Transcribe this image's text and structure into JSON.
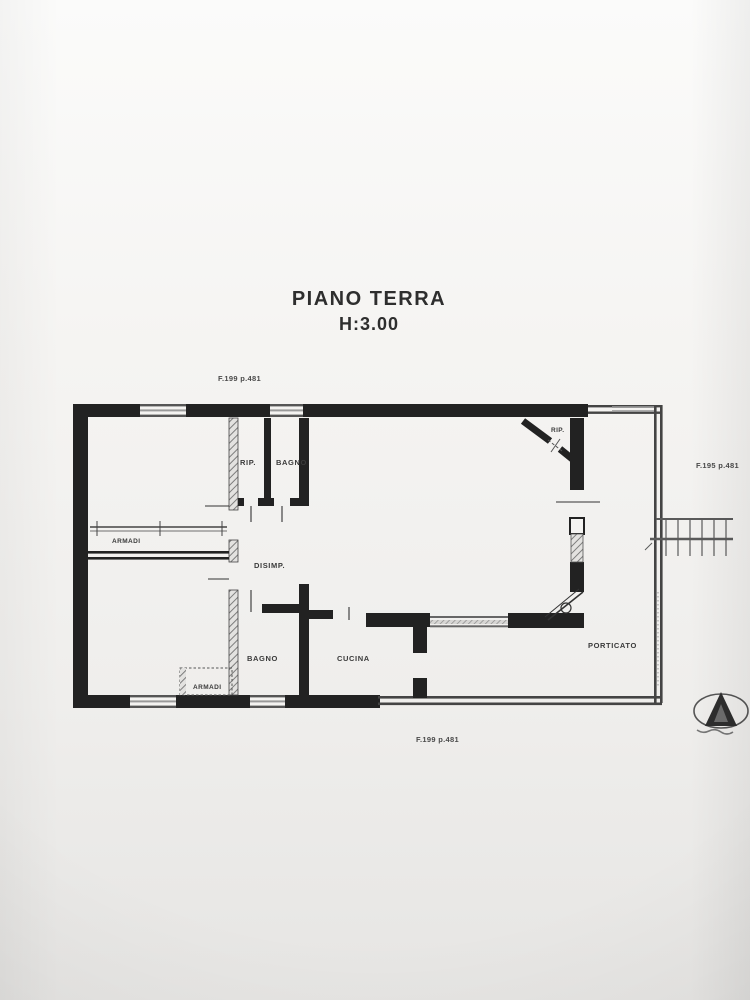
{
  "document": {
    "title": "PIANO TERRA",
    "height_label": "H:3.00"
  },
  "cadastral_refs": {
    "top": "F.199 p.481",
    "right": "F.195 p.481",
    "bottom": "F.199 p.481"
  },
  "room_labels": {
    "rip_top": "RIP.",
    "bagno_top": "BAGNO",
    "rip_corner": "RIP.",
    "armadi_top": "ARMADI",
    "disimpegno": "DISIMP.",
    "bagno_bottom": "BAGNO",
    "cucina": "CUCINA",
    "armadi_bottom": "ARMADI",
    "porticato": "PORTICATO"
  },
  "colors": {
    "paper": "#f4f3f1",
    "ink": "#222222",
    "hatch_gray": "#7d7d7d",
    "window_gray": "#9a9a9a",
    "faint_text": "#4a4a4a"
  }
}
